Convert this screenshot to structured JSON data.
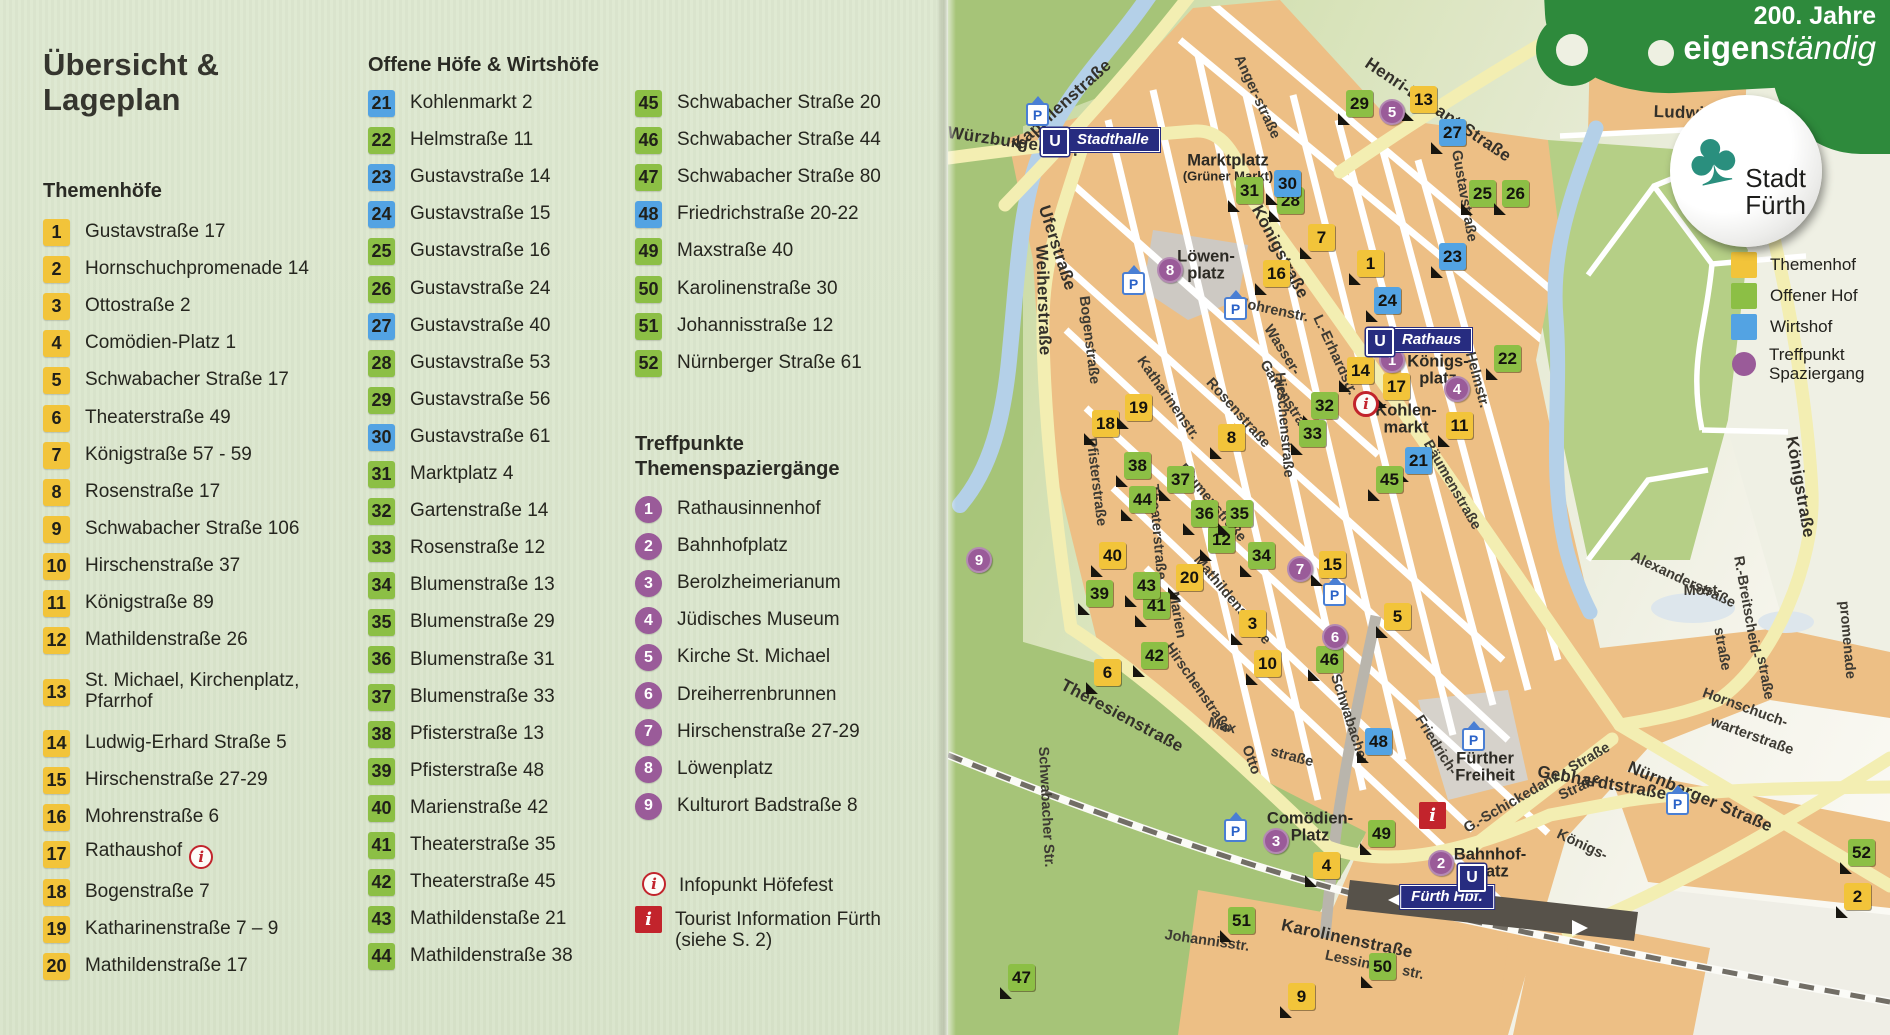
{
  "page": {
    "title_line1": "Übersicht &",
    "title_line2": "Lageplan"
  },
  "sections": {
    "themenhoefe": {
      "heading": "Themenhöfe",
      "items": [
        {
          "n": "1",
          "c": "t",
          "t": "Gustavstraße 17"
        },
        {
          "n": "2",
          "c": "t",
          "t": "Hornschuchpromenade 14"
        },
        {
          "n": "3",
          "c": "t",
          "t": "Ottostraße 2"
        },
        {
          "n": "4",
          "c": "t",
          "t": "Comödien-Platz 1"
        },
        {
          "n": "5",
          "c": "t",
          "t": "Schwabacher Straße 17"
        },
        {
          "n": "6",
          "c": "t",
          "t": "Theaterstraße 49"
        },
        {
          "n": "7",
          "c": "t",
          "t": "Königstraße 57 - 59"
        },
        {
          "n": "8",
          "c": "t",
          "t": "Rosenstraße 17"
        },
        {
          "n": "9",
          "c": "t",
          "t": "Schwabacher Straße 106"
        },
        {
          "n": "10",
          "c": "t",
          "t": "Hirschenstraße 37"
        },
        {
          "n": "11",
          "c": "t",
          "t": "Königstraße 89"
        },
        {
          "n": "12",
          "c": "t",
          "t": "Mathildenstraße 26"
        },
        {
          "n": "13",
          "c": "t",
          "t": "St. Michael, Kirchenplatz,",
          "l2": "Pfarrhof"
        },
        {
          "n": "14",
          "c": "t",
          "t": "Ludwig-Erhard Straße 5"
        },
        {
          "n": "15",
          "c": "t",
          "t": "Hirschenstraße 27-29"
        },
        {
          "n": "16",
          "c": "t",
          "t": "Mohrenstraße 6"
        },
        {
          "n": "17",
          "c": "t",
          "t": "Rathaushof",
          "info": true
        },
        {
          "n": "18",
          "c": "t",
          "t": "Bogenstraße 7"
        },
        {
          "n": "19",
          "c": "t",
          "t": "Katharinenstraße 7 – 9"
        },
        {
          "n": "20",
          "c": "t",
          "t": "Mathildenstraße 17"
        }
      ]
    },
    "offene": {
      "heading": "Offene Höfe & Wirtshöfe",
      "items": [
        {
          "n": "21",
          "c": "w",
          "t": "Kohlenmarkt 2"
        },
        {
          "n": "22",
          "c": "o",
          "t": "Helmstraße 11"
        },
        {
          "n": "23",
          "c": "w",
          "t": "Gustavstraße 14"
        },
        {
          "n": "24",
          "c": "w",
          "t": "Gustavstraße 15"
        },
        {
          "n": "25",
          "c": "o",
          "t": "Gustavstraße 16"
        },
        {
          "n": "26",
          "c": "o",
          "t": "Gustavstraße 24"
        },
        {
          "n": "27",
          "c": "w",
          "t": "Gustavstraße 40"
        },
        {
          "n": "28",
          "c": "o",
          "t": "Gustavstraße 53"
        },
        {
          "n": "29",
          "c": "o",
          "t": "Gustavstraße 56"
        },
        {
          "n": "30",
          "c": "w",
          "t": "Gustavstraße 61"
        },
        {
          "n": "31",
          "c": "o",
          "t": "Marktplatz 4"
        },
        {
          "n": "32",
          "c": "o",
          "t": "Gartenstraße 14"
        },
        {
          "n": "33",
          "c": "o",
          "t": "Rosenstraße 12"
        },
        {
          "n": "34",
          "c": "o",
          "t": "Blumenstraße 13"
        },
        {
          "n": "35",
          "c": "o",
          "t": "Blumenstraße 29"
        },
        {
          "n": "36",
          "c": "o",
          "t": "Blumenstraße 31"
        },
        {
          "n": "37",
          "c": "o",
          "t": "Blumenstraße 33"
        },
        {
          "n": "38",
          "c": "o",
          "t": "Pfisterstraße 13"
        },
        {
          "n": "39",
          "c": "o",
          "t": "Pfisterstraße 48"
        },
        {
          "n": "40",
          "c": "o",
          "t": "Marienstraße 42"
        },
        {
          "n": "41",
          "c": "o",
          "t": "Theaterstraße 35"
        },
        {
          "n": "42",
          "c": "o",
          "t": "Theaterstraße 45"
        },
        {
          "n": "43",
          "c": "o",
          "t": "Mathildenstaße 21"
        },
        {
          "n": "44",
          "c": "o",
          "t": "Mathildenstraße 38"
        }
      ],
      "items2": [
        {
          "n": "45",
          "c": "o",
          "t": "Schwabacher Straße 20"
        },
        {
          "n": "46",
          "c": "o",
          "t": "Schwabacher Straße 44"
        },
        {
          "n": "47",
          "c": "o",
          "t": "Schwabacher Straße 80"
        },
        {
          "n": "48",
          "c": "w",
          "t": "Friedrichstraße 20-22"
        },
        {
          "n": "49",
          "c": "o",
          "t": "Maxstraße 40"
        },
        {
          "n": "50",
          "c": "o",
          "t": "Karolinenstraße 30"
        },
        {
          "n": "51",
          "c": "o",
          "t": "Johannisstraße 12"
        },
        {
          "n": "52",
          "c": "o",
          "t": "Nürnberger Straße 61"
        }
      ]
    },
    "treffpunkte": {
      "heading_line1": "Treffpunkte",
      "heading_line2": "Themenspaziergänge",
      "items": [
        {
          "n": "1",
          "t": "Rathausinnenhof"
        },
        {
          "n": "2",
          "t": "Bahnhofplatz"
        },
        {
          "n": "3",
          "t": "Berolzheimerianum"
        },
        {
          "n": "4",
          "t": "Jüdisches Museum"
        },
        {
          "n": "5",
          "t": "Kirche St. Michael"
        },
        {
          "n": "6",
          "t": "Dreiherrenbrunnen"
        },
        {
          "n": "7",
          "t": "Hirschenstraße 27-29"
        },
        {
          "n": "8",
          "t": "Löwenplatz"
        },
        {
          "n": "9",
          "t": "Kulturort Badstraße 8"
        }
      ]
    },
    "info": {
      "infopunkt": "Infopunkt Höfefest",
      "tourist_line1": "Tourist Information Fürth",
      "tourist_line2": "(siehe S. 2)"
    }
  },
  "legend": {
    "items": [
      {
        "label": "Themenhof",
        "color": "#f2c43a",
        "shape": "square"
      },
      {
        "label": "Offener Hof",
        "color": "#8cbf45",
        "shape": "square"
      },
      {
        "label": "Wirtshof",
        "color": "#53a3e3",
        "shape": "square"
      },
      {
        "label": "Treffpunkt",
        "label2": "Spaziergang",
        "color": "#9a5b99",
        "shape": "circle"
      }
    ]
  },
  "banner": {
    "line1": "200. Jahre",
    "line2_bold": "eigen",
    "line2_italic": "ständig",
    "sticker_line1": "Stadt",
    "sticker_line2": "Fürth",
    "green": "#2e8a3c",
    "clover_color": "#2a8f7e"
  },
  "map": {
    "colors": {
      "themenhof": "#f2c43a",
      "offener_hof": "#8cbf45",
      "wirtshof": "#53a3e3",
      "treffpunkt": "#9a5b99",
      "blocks": "#edbf85",
      "main_road": "#f3eeb2",
      "park": "#a6c478",
      "river": "#b4d0e8",
      "red": "#c2242c",
      "u_blue": "#272c80"
    },
    "markers": [
      {
        "n": "1",
        "c": "t",
        "x": 423,
        "y": 264
      },
      {
        "n": "2",
        "c": "t",
        "x": 910,
        "y": 897
      },
      {
        "n": "3",
        "c": "t",
        "x": 305,
        "y": 624
      },
      {
        "n": "4",
        "c": "t",
        "x": 379,
        "y": 866
      },
      {
        "n": "5",
        "c": "t",
        "x": 450,
        "y": 617
      },
      {
        "n": "6",
        "c": "t",
        "x": 160,
        "y": 673
      },
      {
        "n": "7",
        "c": "t",
        "x": 374,
        "y": 238
      },
      {
        "n": "8",
        "c": "t",
        "x": 284,
        "y": 438
      },
      {
        "n": "9",
        "c": "t",
        "x": 354,
        "y": 997
      },
      {
        "n": "10",
        "c": "t",
        "x": 320,
        "y": 664
      },
      {
        "n": "11",
        "c": "t",
        "x": 512,
        "y": 426
      },
      {
        "n": "12",
        "c": "o",
        "x": 274,
        "y": 540
      },
      {
        "n": "13",
        "c": "t",
        "x": 476,
        "y": 100
      },
      {
        "n": "14",
        "c": "t",
        "x": 413,
        "y": 371
      },
      {
        "n": "15",
        "c": "t",
        "x": 385,
        "y": 565
      },
      {
        "n": "16",
        "c": "t",
        "x": 329,
        "y": 274
      },
      {
        "n": "17",
        "c": "t",
        "x": 449,
        "y": 387
      },
      {
        "n": "18",
        "c": "t",
        "x": 158,
        "y": 424
      },
      {
        "n": "19",
        "c": "t",
        "x": 191,
        "y": 408
      },
      {
        "n": "20",
        "c": "t",
        "x": 242,
        "y": 578
      },
      {
        "n": "21",
        "c": "w",
        "x": 471,
        "y": 461
      },
      {
        "n": "22",
        "c": "o",
        "x": 560,
        "y": 359
      },
      {
        "n": "23",
        "c": "w",
        "x": 505,
        "y": 257
      },
      {
        "n": "24",
        "c": "w",
        "x": 440,
        "y": 301
      },
      {
        "n": "25",
        "c": "o",
        "x": 535,
        "y": 194
      },
      {
        "n": "26",
        "c": "o",
        "x": 568,
        "y": 194
      },
      {
        "n": "27",
        "c": "w",
        "x": 505,
        "y": 133
      },
      {
        "n": "28",
        "c": "o",
        "x": 343,
        "y": 201
      },
      {
        "n": "29",
        "c": "o",
        "x": 412,
        "y": 104
      },
      {
        "n": "30",
        "c": "w",
        "x": 340,
        "y": 184
      },
      {
        "n": "31",
        "c": "o",
        "x": 302,
        "y": 191
      },
      {
        "n": "32",
        "c": "o",
        "x": 377,
        "y": 406
      },
      {
        "n": "33",
        "c": "o",
        "x": 365,
        "y": 434
      },
      {
        "n": "34",
        "c": "o",
        "x": 314,
        "y": 556
      },
      {
        "n": "35",
        "c": "o",
        "x": 292,
        "y": 514
      },
      {
        "n": "36",
        "c": "o",
        "x": 257,
        "y": 514
      },
      {
        "n": "37",
        "c": "o",
        "x": 233,
        "y": 480
      },
      {
        "n": "38",
        "c": "o",
        "x": 190,
        "y": 466
      },
      {
        "n": "39",
        "c": "o",
        "x": 152,
        "y": 594
      },
      {
        "n": "40",
        "c": "t",
        "x": 165,
        "y": 556
      },
      {
        "n": "41",
        "c": "o",
        "x": 209,
        "y": 606
      },
      {
        "n": "42",
        "c": "o",
        "x": 207,
        "y": 656
      },
      {
        "n": "43",
        "c": "o",
        "x": 199,
        "y": 586
      },
      {
        "n": "44",
        "c": "o",
        "x": 195,
        "y": 500
      },
      {
        "n": "45",
        "c": "o",
        "x": 442,
        "y": 480
      },
      {
        "n": "46",
        "c": "o",
        "x": 382,
        "y": 660
      },
      {
        "n": "47",
        "c": "o",
        "x": 74,
        "y": 978
      },
      {
        "n": "48",
        "c": "w",
        "x": 431,
        "y": 742
      },
      {
        "n": "49",
        "c": "o",
        "x": 434,
        "y": 834
      },
      {
        "n": "50",
        "c": "o",
        "x": 435,
        "y": 967
      },
      {
        "n": "51",
        "c": "o",
        "x": 294,
        "y": 921
      },
      {
        "n": "52",
        "c": "o",
        "x": 914,
        "y": 853
      }
    ],
    "walks": [
      {
        "n": "1",
        "x": 444,
        "y": 360
      },
      {
        "n": "2",
        "x": 493,
        "y": 863
      },
      {
        "n": "3",
        "x": 328,
        "y": 841
      },
      {
        "n": "4",
        "x": 509,
        "y": 389
      },
      {
        "n": "5",
        "x": 444,
        "y": 112
      },
      {
        "n": "6",
        "x": 387,
        "y": 637
      },
      {
        "n": "7",
        "x": 352,
        "y": 569
      },
      {
        "n": "8",
        "x": 222,
        "y": 270
      },
      {
        "n": "9",
        "x": 31,
        "y": 560
      }
    ],
    "streets": [
      {
        "t": "Kapellenstraße",
        "x": 114,
        "y": 105,
        "r": -42,
        "b": 1
      },
      {
        "t": "Würzburger Str.",
        "x": 65,
        "y": 142,
        "r": 8,
        "b": 1
      },
      {
        "t": "Uferstraße",
        "x": 109,
        "y": 248,
        "r": 72,
        "b": 1
      },
      {
        "t": "Weiherstraße",
        "x": 95,
        "y": 300,
        "r": 88,
        "b": 1
      },
      {
        "t": "Anger-straße",
        "x": 309,
        "y": 97,
        "r": 65
      },
      {
        "t": "Henri-Dunant-Straße",
        "x": 490,
        "y": 110,
        "r": 34,
        "b": 1
      },
      {
        "t": "Ludwigbrücke",
        "x": 765,
        "y": 114,
        "r": 2,
        "b": 1
      },
      {
        "t": "Königstraße",
        "x": 332,
        "y": 252,
        "r": 62,
        "b": 1
      },
      {
        "t": "Gustavstraße",
        "x": 516,
        "y": 196,
        "r": 80
      },
      {
        "t": "Mohrenstr.",
        "x": 324,
        "y": 310,
        "r": 12
      },
      {
        "t": "L.-Erhardstr.",
        "x": 387,
        "y": 355,
        "r": 65
      },
      {
        "t": "Wasser-",
        "x": 334,
        "y": 350,
        "r": 58
      },
      {
        "t": "Gartenstraße",
        "x": 339,
        "y": 400,
        "r": 58
      },
      {
        "t": "Rosenstraße",
        "x": 290,
        "y": 413,
        "r": 48
      },
      {
        "t": "Katharinenstr.",
        "x": 220,
        "y": 398,
        "r": 55
      },
      {
        "t": "Blumenstraße",
        "x": 264,
        "y": 503,
        "r": 50
      },
      {
        "t": "Bogenstraße",
        "x": 141,
        "y": 340,
        "r": 83
      },
      {
        "t": "Pfisterstraße",
        "x": 148,
        "y": 482,
        "r": 83
      },
      {
        "t": "Theaterstraße",
        "x": 209,
        "y": 532,
        "r": 85
      },
      {
        "t": "Marien",
        "x": 229,
        "y": 615,
        "r": 80
      },
      {
        "t": "Hirschenstraße",
        "x": 336,
        "y": 425,
        "r": 85
      },
      {
        "t": "Hirschenstraße",
        "x": 250,
        "y": 688,
        "r": 55
      },
      {
        "t": "Theresienstraße",
        "x": 174,
        "y": 716,
        "r": 28,
        "b": 1
      },
      {
        "t": "Mathildenstraße",
        "x": 284,
        "y": 600,
        "r": 50
      },
      {
        "t": "Max",
        "x": 274,
        "y": 726,
        "r": 15
      },
      {
        "t": "Otto",
        "x": 303,
        "y": 760,
        "r": 70
      },
      {
        "t": "straße",
        "x": 344,
        "y": 757,
        "r": 15
      },
      {
        "t": "Schwabacher",
        "x": 401,
        "y": 719,
        "r": 72
      },
      {
        "t": "Schwabacher Str.",
        "x": 98,
        "y": 807,
        "r": 87
      },
      {
        "t": "Friedrich-",
        "x": 488,
        "y": 745,
        "r": 58
      },
      {
        "t": "R.-Breitscheid-",
        "x": 799,
        "y": 607,
        "r": 80
      },
      {
        "t": "straße",
        "x": 817,
        "y": 678,
        "r": 80
      },
      {
        "t": "G.-Schickedanz - Straße",
        "x": 589,
        "y": 788,
        "r": -30
      },
      {
        "t": "Straße",
        "x": 632,
        "y": 787,
        "r": -25
      },
      {
        "t": "Alexanderstraße",
        "x": 735,
        "y": 580,
        "r": 25
      },
      {
        "t": "Most-",
        "x": 755,
        "y": 591,
        "r": 0
      },
      {
        "t": "straße",
        "x": 774,
        "y": 649,
        "r": 80
      },
      {
        "t": "Königstraße",
        "x": 852,
        "y": 487,
        "r": 80,
        "b": 1
      },
      {
        "t": "Nürnberger Straße",
        "x": 752,
        "y": 797,
        "r": 23,
        "b": 1
      },
      {
        "t": "Königs-",
        "x": 634,
        "y": 845,
        "r": 25
      },
      {
        "t": "warterstraße",
        "x": 804,
        "y": 736,
        "r": 20
      },
      {
        "t": "Hornschuch-",
        "x": 797,
        "y": 708,
        "r": 20
      },
      {
        "t": "promenade",
        "x": 899,
        "y": 640,
        "r": 85
      },
      {
        "t": "Gebhardtstraße",
        "x": 654,
        "y": 783,
        "r": 10,
        "b": 1
      },
      {
        "t": "Karolinenstraße",
        "x": 399,
        "y": 939,
        "r": 12,
        "b": 1
      },
      {
        "t": "Johannisstr.",
        "x": 259,
        "y": 941,
        "r": 8
      },
      {
        "t": "Lessing",
        "x": 404,
        "y": 961,
        "r": 12
      },
      {
        "t": "str.",
        "x": 465,
        "y": 973,
        "r": 12
      },
      {
        "t": "Bäumenstraße",
        "x": 504,
        "y": 485,
        "r": 60
      },
      {
        "t": "Helmstr.",
        "x": 529,
        "y": 380,
        "r": 75
      }
    ],
    "places": [
      {
        "l1": "Marktplatz",
        "l2": "(Grüner Markt)",
        "x": 280,
        "y": 168
      },
      {
        "l1": "Löwen-",
        "l2": "platz",
        "x": 258,
        "y": 266
      },
      {
        "l1": "Königs-",
        "l2": "platz",
        "x": 490,
        "y": 371
      },
      {
        "l1": "Kohlen-",
        "l2": "markt",
        "x": 458,
        "y": 420
      },
      {
        "l1": "Comödien-",
        "l2": "Platz",
        "x": 362,
        "y": 828
      },
      {
        "l1": "Bahnhof-",
        "l2": "platz",
        "x": 542,
        "y": 864
      },
      {
        "l1": "Fürther",
        "l2": "Freiheit",
        "x": 537,
        "y": 768
      }
    ],
    "badges": [
      {
        "t": "Stadthalle",
        "ux": 105,
        "uy": 140,
        "x": 122,
        "y": 140
      },
      {
        "t": "Rathaus",
        "ux": 430,
        "uy": 340,
        "x": 447,
        "y": 340
      },
      {
        "t": "Fürth Hbf.",
        "ux": 522,
        "uy": 876,
        "x": 499,
        "y": 897,
        "center": 1
      }
    ],
    "p_icons": [
      [
        87,
        112
      ],
      [
        183,
        281
      ],
      [
        285,
        306
      ],
      [
        384,
        592
      ],
      [
        523,
        737
      ],
      [
        285,
        828
      ],
      [
        727,
        801
      ]
    ],
    "info_icons": [
      {
        "k": "circle",
        "x": 418,
        "y": 404
      },
      {
        "k": "square",
        "x": 484,
        "y": 815
      }
    ]
  }
}
